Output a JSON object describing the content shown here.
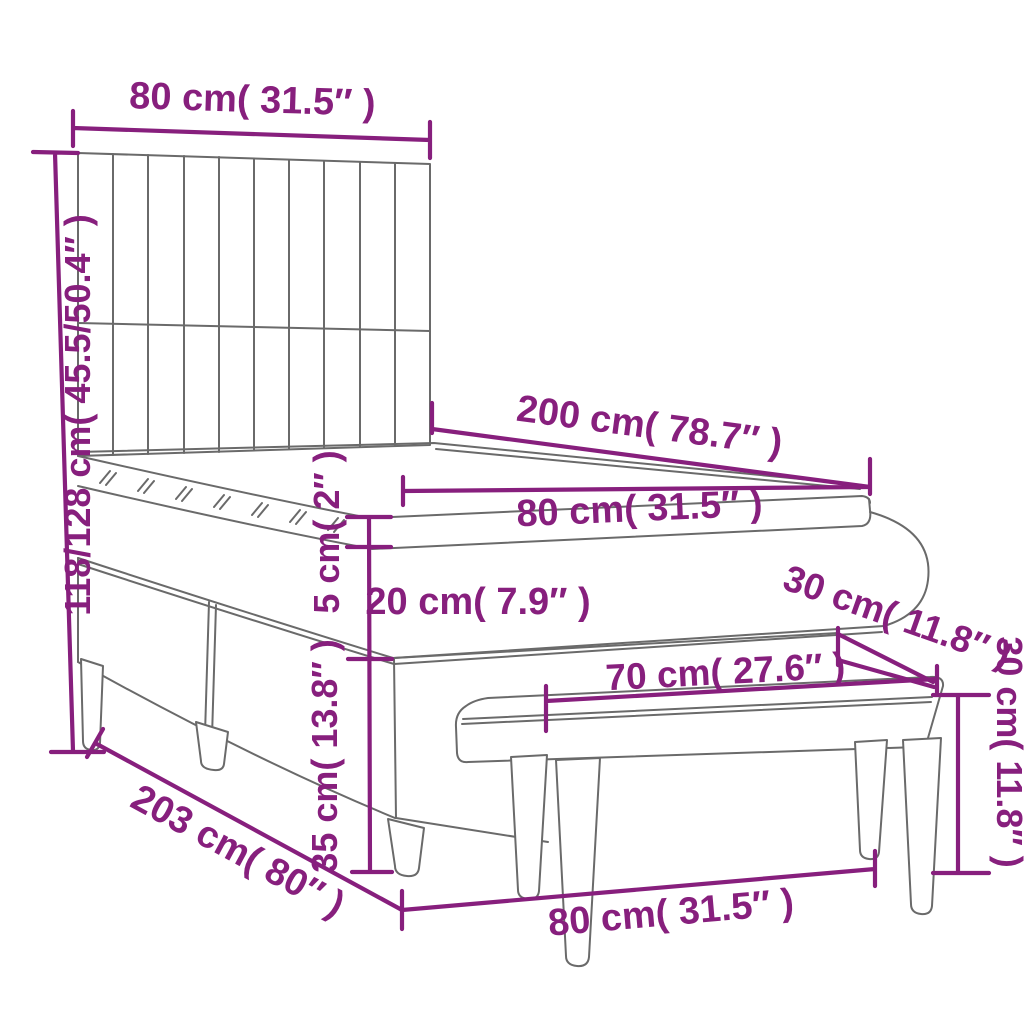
{
  "title": "Box spring bed with headboard and bench dimension diagram",
  "colors": {
    "accent": "#871F7D",
    "outline": "#6a6a6a",
    "background": "#ffffff"
  },
  "units": {
    "metric": "cm",
    "imperial": "inches"
  },
  "labels": {
    "headboard_width": "80 cm( 31.5″ )",
    "total_height": "118/128 cm( 45.5/50.4″ )",
    "bed_length": "200 cm( 78.7″ )",
    "mattress_width": "80 cm( 31.5″ )",
    "topper_thickness": "5 cm( 2″ )",
    "mattress_thickness": "20 cm( 7.9″ )",
    "base_height": "35 cm( 13.8″ )",
    "bed_floor_length": "203 cm( 80″ )",
    "bench_depth": "30 cm( 11.8″ )",
    "bench_seat_length": "70 cm( 27.6″ )",
    "bench_height": "30 cm( 11.8″ )",
    "bench_length": "80 cm( 31.5″ )"
  }
}
